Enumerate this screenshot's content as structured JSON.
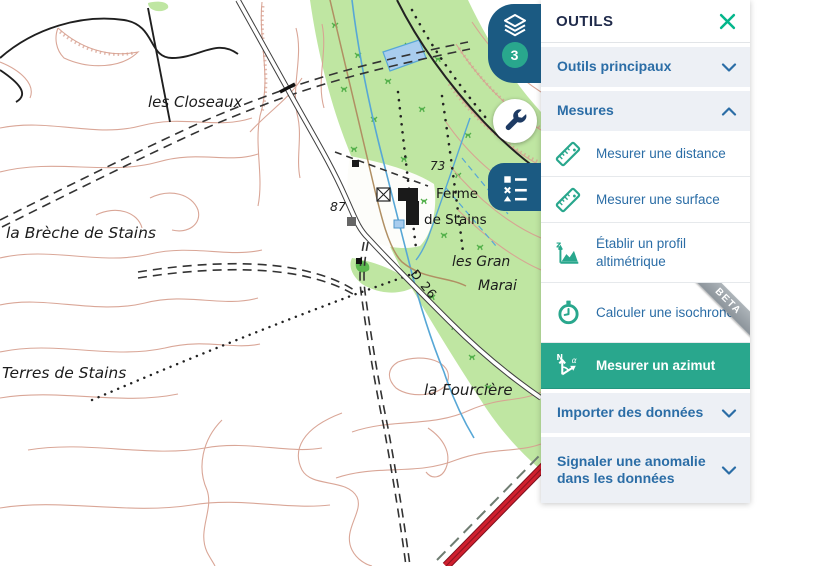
{
  "panel": {
    "title": "OUTILS",
    "sections": {
      "principaux": {
        "label": "Outils principaux",
        "state": "collapsed"
      },
      "mesures": {
        "label": "Mesures",
        "state": "expanded"
      },
      "importer": {
        "label": "Importer des données",
        "state": "collapsed"
      },
      "signaler": {
        "label": "Signaler une anomalie dans les données",
        "state": "collapsed"
      }
    },
    "tools": {
      "distance": {
        "label": "Mesurer une distance"
      },
      "surface": {
        "label": "Mesurer une surface"
      },
      "profil": {
        "label": "Établir un profil altimétrique"
      },
      "isochrone": {
        "label": "Calculer une isochrone",
        "badge": "BETA"
      },
      "azimut": {
        "label": "Mesurer un azimut",
        "selected": true
      }
    },
    "icon_glyphs": {
      "profile_axis": "z",
      "azimut_north": "N",
      "azimut_angle": "α"
    }
  },
  "side_toolbar": {
    "layers_badge": "3"
  },
  "map": {
    "labels": {
      "closeaux": "les Closeaux",
      "breche": "la Brèche de Stains",
      "terres": "Terres de Stains",
      "fourciere": "la Fourcière",
      "grands_line1": "les Gran",
      "grands_line2": "Marai",
      "ferme_line1": "Ferme",
      "ferme_line2": "de Stains",
      "road_ref": "D 26",
      "elev_73": "73",
      "elev_87": "87"
    }
  },
  "colors": {
    "accent_green": "#29a78d",
    "close_green": "#04b68c",
    "panel_link_blue": "#2b6da6",
    "header_navy": "#1f2a4a",
    "side_button_blue": "#1b5a82",
    "beta_gray": "#98a0a6",
    "map_contour": "#d8a292",
    "map_green": "#bfe6a2",
    "map_stream_blue": "#57a7d6",
    "map_red_road": "#d0202f"
  }
}
